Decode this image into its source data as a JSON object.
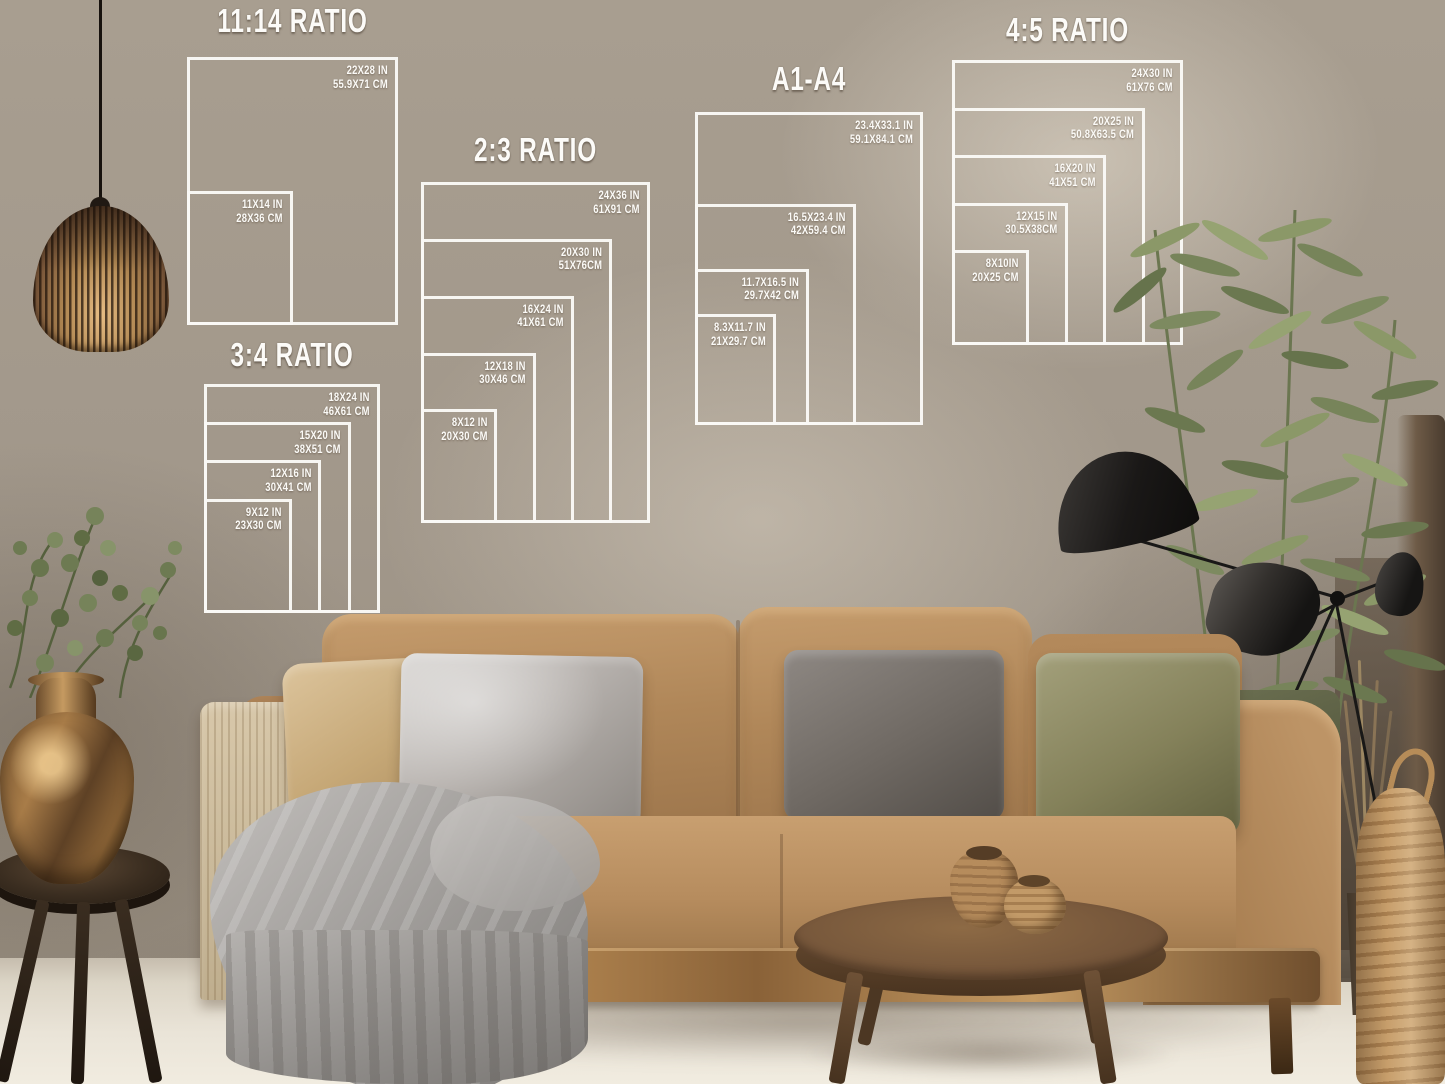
{
  "charts": [
    {
      "id": "ratio-11-14",
      "title": "11:14 RATIO",
      "sizes": [
        {
          "in": "22X28 IN",
          "cm": "55.9X71 CM",
          "w": 22,
          "h": 28
        },
        {
          "in": "11X14 IN",
          "cm": "28X36 CM",
          "w": 11,
          "h": 14
        }
      ]
    },
    {
      "id": "ratio-2-3",
      "title": "2:3 RATIO",
      "sizes": [
        {
          "in": "24X36 IN",
          "cm": "61X91 CM",
          "w": 24,
          "h": 36
        },
        {
          "in": "20X30 IN",
          "cm": "51X76CM",
          "w": 20,
          "h": 30
        },
        {
          "in": "16X24 IN",
          "cm": "41X61 CM",
          "w": 16,
          "h": 24
        },
        {
          "in": "12X18 IN",
          "cm": "30X46 CM",
          "w": 12,
          "h": 18
        },
        {
          "in": "8X12 IN",
          "cm": "20X30 CM",
          "w": 8,
          "h": 12
        }
      ]
    },
    {
      "id": "a1-a4",
      "title": "A1-A4",
      "sizes": [
        {
          "in": "23.4X33.1 IN",
          "cm": "59.1X84.1 CM",
          "w": 23.4,
          "h": 33.1
        },
        {
          "in": "16.5X23.4 IN",
          "cm": "42X59.4 CM",
          "w": 16.5,
          "h": 23.4
        },
        {
          "in": "11.7X16.5 IN",
          "cm": "29.7X42 CM",
          "w": 11.7,
          "h": 16.5
        },
        {
          "in": "8.3X11.7 IN",
          "cm": "21X29.7 CM",
          "w": 8.3,
          "h": 11.7
        }
      ]
    },
    {
      "id": "ratio-4-5",
      "title": "4:5 RATIO",
      "sizes": [
        {
          "in": "24X30 IN",
          "cm": "61X76 CM",
          "w": 24,
          "h": 30
        },
        {
          "in": "20X25 IN",
          "cm": "50.8X63.5 CM",
          "w": 20,
          "h": 25
        },
        {
          "in": "16X20 IN",
          "cm": "41X51 CM",
          "w": 16,
          "h": 20
        },
        {
          "in": "12X15 IN",
          "cm": "30.5X38CM",
          "w": 12,
          "h": 15
        },
        {
          "in": "8X10IN",
          "cm": "20X25 CM",
          "w": 8,
          "h": 10
        }
      ]
    },
    {
      "id": "ratio-3-4",
      "title": "3:4 RATIO",
      "sizes": [
        {
          "in": "18X24 IN",
          "cm": "46X61 CM",
          "w": 18,
          "h": 24
        },
        {
          "in": "15X20 IN",
          "cm": "38X51 CM",
          "w": 15,
          "h": 20
        },
        {
          "in": "12X16 IN",
          "cm": "30X41 CM",
          "w": 12,
          "h": 16
        },
        {
          "in": "9X12 IN",
          "cm": "23X30 CM",
          "w": 9,
          "h": 12
        }
      ]
    }
  ],
  "palette": {
    "overlay_white": "#fbfaf7",
    "wall_taupe": "#a1978a",
    "sofa_camel": "#b68c5e",
    "wood_brown": "#8a6238",
    "blanket_gray": "#a5a29f",
    "plant_green": "#7b885c",
    "lamp_black": "#1d1b19",
    "floor_beige": "#e2dbcd",
    "vase_bronze": "#a87c48"
  }
}
